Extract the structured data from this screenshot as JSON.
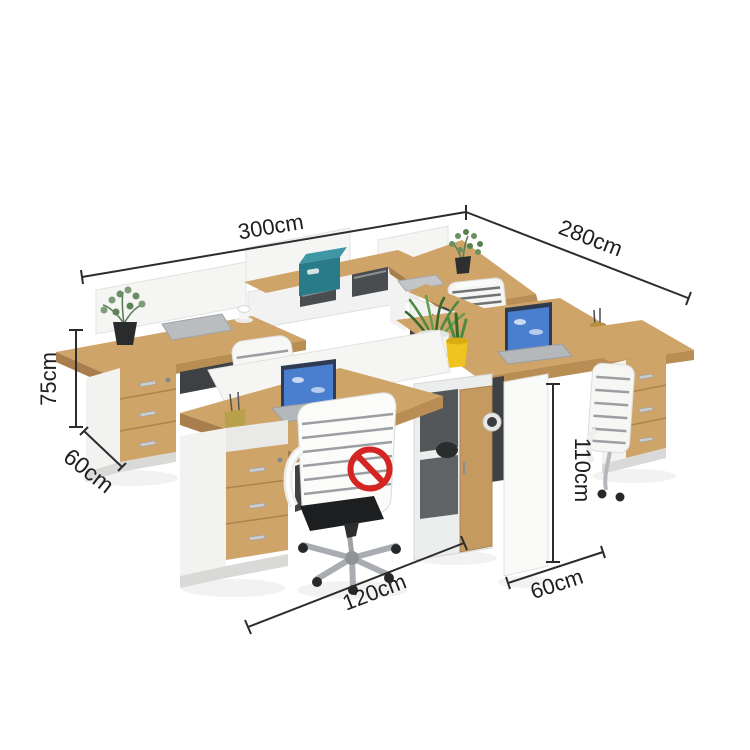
{
  "scene": {
    "description": "Four-seat cross-shaped staff office workstation in light wood and white, with desktop screens, mobile pedestals, plants, laptops and a crossed-out office chair (chair not included)."
  },
  "dimensions": {
    "overall_width": "300cm",
    "overall_depth": "280cm",
    "desk_height": "75cm",
    "pedestal_depth": "60cm",
    "panel_height": "110cm",
    "single_desk_width": "120cm",
    "side_desk_depth": "60cm"
  },
  "icons": {
    "no_symbol": "red-prohibition-circle-slash"
  },
  "colors": {
    "wood": "#cfa469",
    "wood_dark": "#b98e55",
    "panel_white": "#f5f5f3",
    "shadow_gray": "#3e4144",
    "teal_box": "#2a7b8a",
    "teal_box_top": "#3f96a4",
    "pot_yellow": "#f0c41e",
    "plant_green": "#4c8a3f",
    "screen_blue": "#4a7fd0",
    "prohibition_red": "#d42522",
    "dimension_line": "#2c2c2c"
  }
}
